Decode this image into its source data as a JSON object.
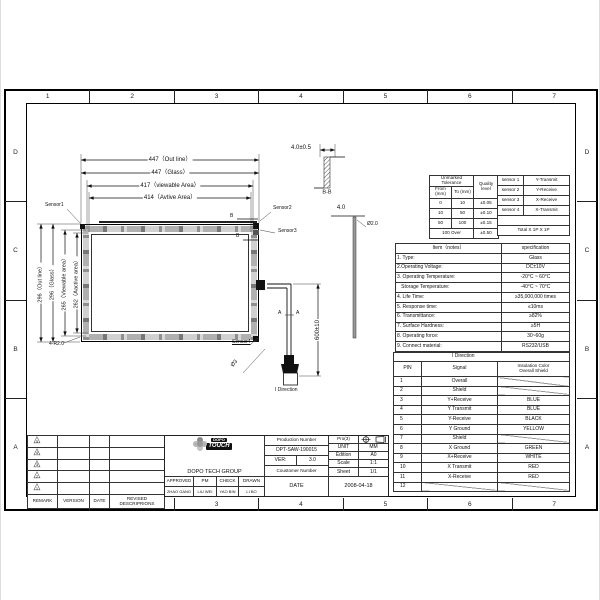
{
  "sheet": {
    "grid_top": [
      "1",
      "2",
      "3",
      "4",
      "5",
      "6",
      "7"
    ],
    "grid_bottom": [
      "1",
      "2",
      "3",
      "4",
      "5",
      "6",
      "7"
    ],
    "grid_left": [
      "D",
      "C",
      "B",
      "A"
    ],
    "grid_right": [
      "D",
      "C",
      "B",
      "A"
    ]
  },
  "drawing": {
    "dim_outline_w": "447（Out line）",
    "dim_glass_w": "447（Glass）",
    "dim_viewable_w": "417（viewable Area）",
    "dim_active_w": "414（Avtive Area）",
    "dim_outline_h": "296（Out line）",
    "dim_glass_h": "296（Glass）",
    "dim_viewable_h": "265（Viewable area）",
    "dim_active_h": "262（Aactive area）",
    "sensor1": "Sensor1",
    "sensor2": "Sensor2",
    "sensor3": "Sensor3",
    "sensor4": "Sensor4",
    "corner_radius": "4-R2.0",
    "cable_length": "600±10",
    "section_a": "A",
    "section_b": "B",
    "section_bb": "B-B",
    "thickness": "4.0±0.5",
    "glass_edge": "4.0",
    "glass_dia": "Ø2.0",
    "cable_dia": "Ø3",
    "connector_label": "I Direction"
  },
  "tolerance_table": {
    "title": "Unmarked Tolerance",
    "col_from": "From (mm)",
    "col_to": "To (mm)",
    "col_quality": "Quality level",
    "rows": [
      [
        "0",
        "10",
        "±0.05"
      ],
      [
        "10",
        "50",
        "±0.10"
      ],
      [
        "50",
        "100",
        "±0.15"
      ]
    ],
    "over_row": [
      "100 Over",
      "±0.50"
    ],
    "sensors": [
      [
        "sensor 1",
        "Y-Transmit"
      ],
      [
        "sensor 2",
        "Y-Receive"
      ],
      [
        "sensor 3",
        "X-Receive"
      ],
      [
        "sensor 4",
        "X-Transmit"
      ]
    ],
    "total": "Total X  1P   X  1P"
  },
  "spec_table": {
    "header": [
      "Item（notes）",
      "specification"
    ],
    "rows": [
      [
        "1. Type:",
        "Glass"
      ],
      [
        "2.Operating Voltage:",
        "DC±10V"
      ],
      [
        "3. Operating Temperature:",
        "-20°C ~ 60°C"
      ],
      [
        "   Storage Temperature:",
        "-40°C ~ 70°C"
      ],
      [
        "4. Life Time:",
        "≥35,000,000 times"
      ],
      [
        "5. Response time:",
        "≤10ms"
      ],
      [
        "6. Transmittance:",
        "≥82%"
      ],
      [
        "7. Surface Hardness:",
        "≥5H"
      ],
      [
        "8. Operating force:",
        "30~60g"
      ],
      [
        "9. Connect material:",
        "RS232/USB"
      ]
    ]
  },
  "pin_table": {
    "title": "I  Direction",
    "col_pin": "PIN",
    "col_signal": "Signal",
    "col_color_1": "Insulation Color",
    "col_color_2": "Overall Shield",
    "rows": [
      [
        "1",
        "Overall",
        ""
      ],
      [
        "2",
        "Shield",
        ""
      ],
      [
        "3",
        "Y+Receive",
        "BLUE"
      ],
      [
        "4",
        "Y Transmit",
        "BLUE"
      ],
      [
        "5",
        "Y-Receive",
        "BLACK"
      ],
      [
        "6",
        "Y Ground",
        "YELLOW"
      ],
      [
        "7",
        "Shield",
        ""
      ],
      [
        "8",
        "X Ground",
        "GREEN"
      ],
      [
        "9",
        "X+Receive",
        "WHITE"
      ],
      [
        "10",
        "X Transmit",
        "RED"
      ],
      [
        "11",
        "X-Receive",
        "RED"
      ],
      [
        "12",
        "",
        ""
      ]
    ]
  },
  "revision_table": {
    "mark_glyph": "△",
    "marks": [
      "5",
      "4",
      "3",
      "2",
      "1"
    ],
    "col_remark": "REMARK",
    "col_version": "VERSION",
    "col_date": "DATE",
    "col_desc": "REVISED DESCRIPRIONS"
  },
  "title_block": {
    "logo_top": "DOPO",
    "logo_main": "TOUCH",
    "company": "DOPO TECH GROUP",
    "production_number_label": "Production Number",
    "production_number": "DPT-SAW-190015",
    "ver_label": "VER:",
    "ver": "3.0",
    "customer_label": "Coustomer Number",
    "pro_label": "Pro(3)",
    "unit_label": "UNIT",
    "unit": "MM",
    "edition_label": "Edition",
    "edition": "A0",
    "scale_label": "Scale",
    "scale": "1:1",
    "sheet_label": "Sheet",
    "sheet": "1/1",
    "approved_label": "APPROVED",
    "pm_label": "PM",
    "check_label": "CHECK",
    "drawn_label": "DRAWN",
    "approved": "ZHAO GANG",
    "pm": "LIU WEI",
    "check": "YAO BIN",
    "drawn": "LI BO",
    "date_label": "DATE",
    "date": "2008-04-18"
  }
}
